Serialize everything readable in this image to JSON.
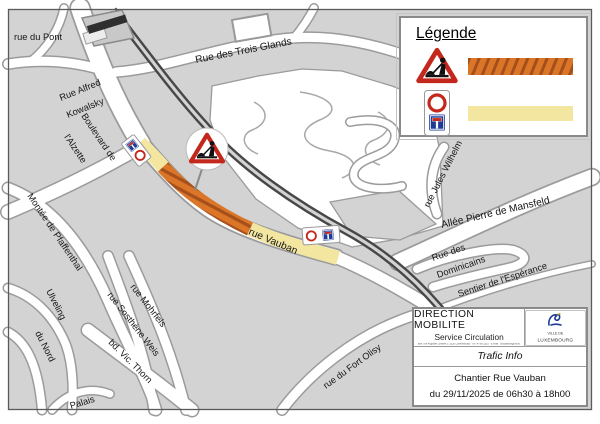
{
  "legend": {
    "title": "Légende",
    "items": [
      {
        "icon": "roadwork-sign",
        "meaning_color": "#db7527",
        "style": "hatched"
      },
      {
        "icon": "no-entry-dead-end-sign",
        "meaning_color": "#f2e6a1",
        "style": "solid"
      }
    ]
  },
  "infobox": {
    "title": "DIRECTION MOBILITE",
    "subtitle": "Service Circulation",
    "address": "98A, rue Auguste Charles L-1326 Luxembourg  -  Tél. 4796-2310  -  E-mail : circulation@vdl.lu",
    "section": "Trafic Info",
    "notice_line1": "Chantier Rue Vauban",
    "notice_line2": "du 29/11/2025 de 06h30 à 18h00",
    "logo_line1": "VILLE DE",
    "logo_line2": "LUXEMBOURG"
  },
  "map": {
    "labels": [
      {
        "text": "rue du Pont"
      },
      {
        "text": "Rue des Trois Glands"
      },
      {
        "text": "Rue Alfred"
      },
      {
        "text": "Kowalsky"
      },
      {
        "text": "Boulevard de"
      },
      {
        "text": "l'Alzette"
      },
      {
        "text": "Montée de Pfaffenthal"
      },
      {
        "text": "Ulveling"
      },
      {
        "text": "du Nord"
      },
      {
        "text": "rue Mohrfels"
      },
      {
        "text": "rue Sosthène Weis"
      },
      {
        "text": "bd.  Vic. Thorn"
      },
      {
        "text": "Palais"
      },
      {
        "text": "rue du Fort Olisy"
      },
      {
        "text": "rue Vauban"
      },
      {
        "text": "rue Jules Wilhelm"
      },
      {
        "text": "Allée Pierre de Mansfeld"
      },
      {
        "text": "Rue des"
      },
      {
        "text": "Dominicains"
      },
      {
        "text": "Sentier de l'Espérance"
      }
    ],
    "colors": {
      "work_zone": "#db7527",
      "work_zone_stripe": "#a5501c",
      "closed_section": "#f2e6a1",
      "railway": "#474747",
      "block": "#d3d3d3",
      "street_casing": "#9b9b9b",
      "sign_red": "#c4281c",
      "sign_blue": "#1e3c96"
    }
  }
}
